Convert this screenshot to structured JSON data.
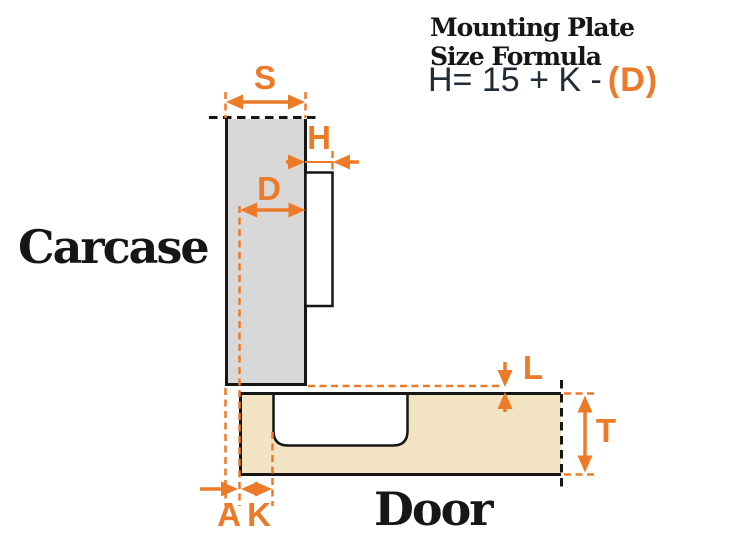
{
  "formula_panel": {
    "title_line1": "Mounting Plate",
    "title_line2": "Size Formula",
    "formula_prefix": "H= 15 + K -",
    "formula_highlight": "(D)"
  },
  "diagram": {
    "carcase_label": "Carcase",
    "door_label": "Door",
    "dimensions": {
      "s": "S",
      "h": "H",
      "d": "D",
      "l": "L",
      "t": "T",
      "a": "A",
      "k": "K"
    }
  },
  "colors": {
    "accent_orange": "#ED7A29",
    "carcase_fill": "#D8D8D8",
    "door_fill": "#F2E3C2",
    "outline_black": "#161616",
    "formula_text": "#232B39"
  }
}
